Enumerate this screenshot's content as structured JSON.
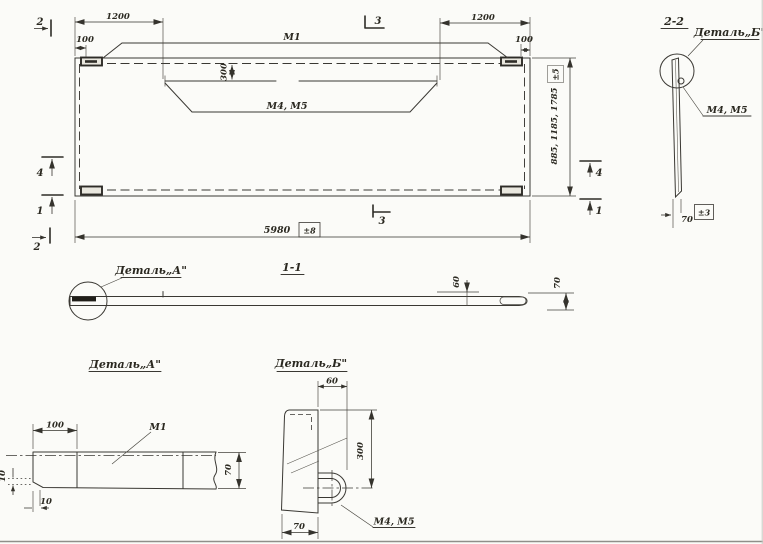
{
  "main_view": {
    "label_m1": "М1",
    "label_m4m5": "М4, М5",
    "dim_1200_left": "1200",
    "dim_100_left": "100",
    "dim_1200_right": "1200",
    "dim_100_right": "100",
    "dim_300": "300",
    "dim_length": "5980",
    "tol_length": "±8",
    "dim_heights": "885, 1185, 1785",
    "tol_heights": "±5",
    "mark_2_top": "2",
    "mark_2_bottom": "2",
    "mark_3_top": "3",
    "mark_3_bottom": "3",
    "mark_4_left": "4",
    "mark_1_left": "1",
    "mark_4_right": "4",
    "mark_1_right": "1"
  },
  "section_1_1": {
    "title": "1-1",
    "detail_a_callout": "Деталь„А\"",
    "dim_60": "60",
    "dim_70": "70"
  },
  "section_2_2": {
    "title": "2-2",
    "detail_b_callout": "Деталь„Б\"",
    "label_m4m5": "М4, М5",
    "dim_70": "70",
    "tol_70": "±3"
  },
  "detail_a": {
    "title": "Деталь„А\"",
    "label_m1": "М1",
    "dim_100": "100",
    "dim_70": "70",
    "dim_10_side": "10",
    "dim_10_bottom": "10"
  },
  "detail_b": {
    "title": "Деталь„Б\"",
    "dim_60": "60",
    "dim_300": "300",
    "dim_70": "70",
    "label_m4m5": "М4, М5"
  }
}
